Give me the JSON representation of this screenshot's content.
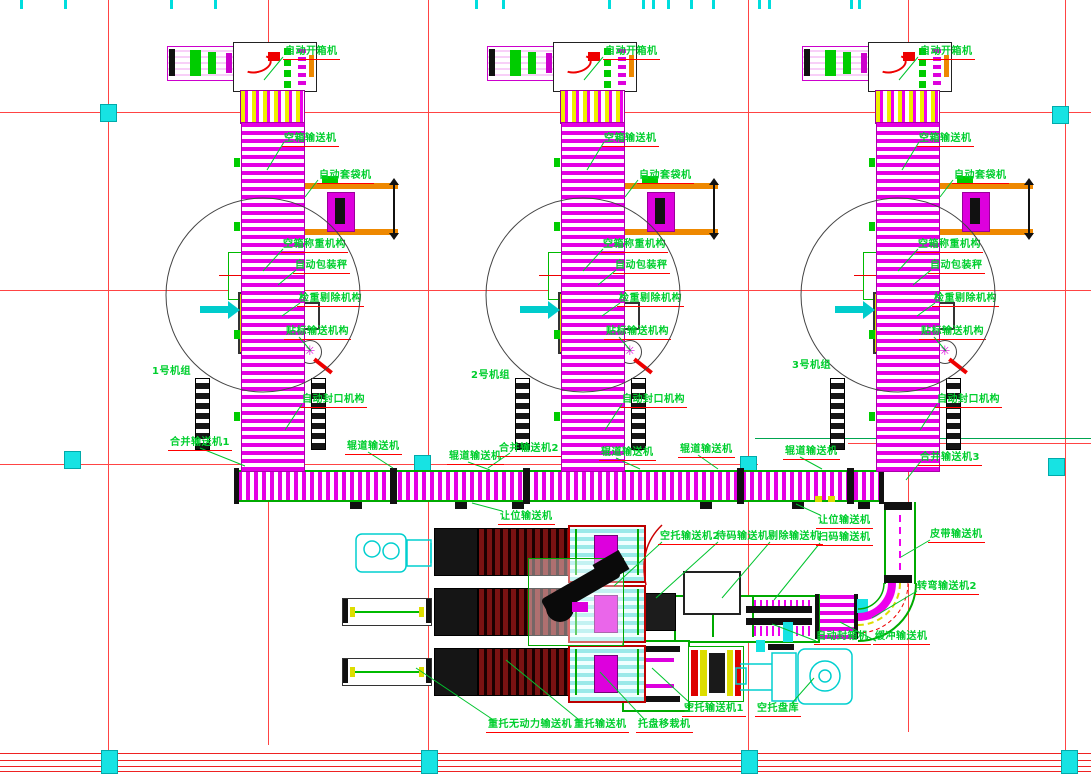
{
  "drawing": {
    "units": [
      {
        "name": "1号机组"
      },
      {
        "name": "2号机组"
      },
      {
        "name": "3号机组"
      }
    ],
    "labels": {
      "auto_box_opener": "自动开箱机",
      "empty_box_conveyor": "空箱输送机",
      "auto_bagging_machine": "自动套袋机",
      "empty_box_weighing": "空箱称重机构",
      "auto_packing_scale": "自动包装秤",
      "checkweigher_reject": "检重剔除机构",
      "labeling_conveyor": "贴标输送机构",
      "auto_sealing": "自动封口机构",
      "merge_conveyor_1": "合并输送机1",
      "merge_conveyor_2": "合并输送机2",
      "merge_conveyor_3": "合并输送机3",
      "roller_conveyor": "辊道输送机",
      "yield_conveyor": "让位输送机",
      "empty_pallet_conveyor_2": "空托输送机2",
      "staging_conveyor": "待码输送机",
      "reject_conveyor": "剔除输送机",
      "barcode_conveyor": "扫码输送机",
      "belt_conveyor": "皮带输送机",
      "curve_conveyor_2": "转弯输送机2",
      "auto_carton_sealer": "自动封箱机",
      "buffer_conveyor": "缓冲输送机",
      "loaded_pallet_gravity_conveyor": "重托无动力输送机",
      "loaded_pallet_conveyor": "重托输送机",
      "pallet_transfer_machine": "托盘移栽机",
      "empty_pallet_conveyor_1": "空托输送机1",
      "empty_pallet_storage": "空托盘库"
    },
    "colors": {
      "label_green": "#00cf2e",
      "leader_green": "#00c42e",
      "grid_red": "#ff4444",
      "marker_cyan": "#17e3e3",
      "conveyor_magenta": "#e400e4",
      "pallet_dark_red": "#7a1212",
      "machine_orange": "#ee8800",
      "vehicle_cyan": "#00dddd"
    }
  }
}
